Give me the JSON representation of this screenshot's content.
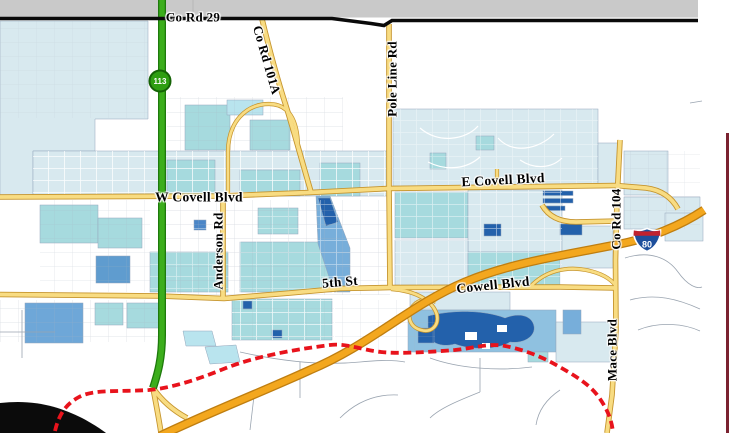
{
  "labels": {
    "co_rd_29": "Co Rd 29",
    "co_rd_101a": "Co Rd 101A",
    "pole_line_rd": "Pole Line Rd",
    "w_covell_blvd": "W Covell Blvd",
    "e_covell_blvd": "E Covell Blvd",
    "anderson_rd": "Anderson Rd",
    "fifth_st": "5th St",
    "cowell_blvd": "Cowell Blvd",
    "co_rd_104": "Co Rd 104",
    "mace_blvd": "Mace Blvd"
  },
  "shields": {
    "sr113": "113",
    "i80": "80"
  },
  "colors": {
    "freeway_orange": "#F3A71E",
    "highway_green": "#3CAE1C",
    "arterial_yellow": "#F8DC82",
    "county_line_black": "#0A0A0A",
    "city_limit_red": "#E8131C",
    "zone_pale_blue": "#D8E9EF",
    "zone_teal": "#A6DADE",
    "zone_medium_blue": "#77AEDA",
    "zone_dark_blue": "#2361AB",
    "outside_area_gray": "#C9C9C9",
    "frame_line_maroon": "#7A2230"
  }
}
